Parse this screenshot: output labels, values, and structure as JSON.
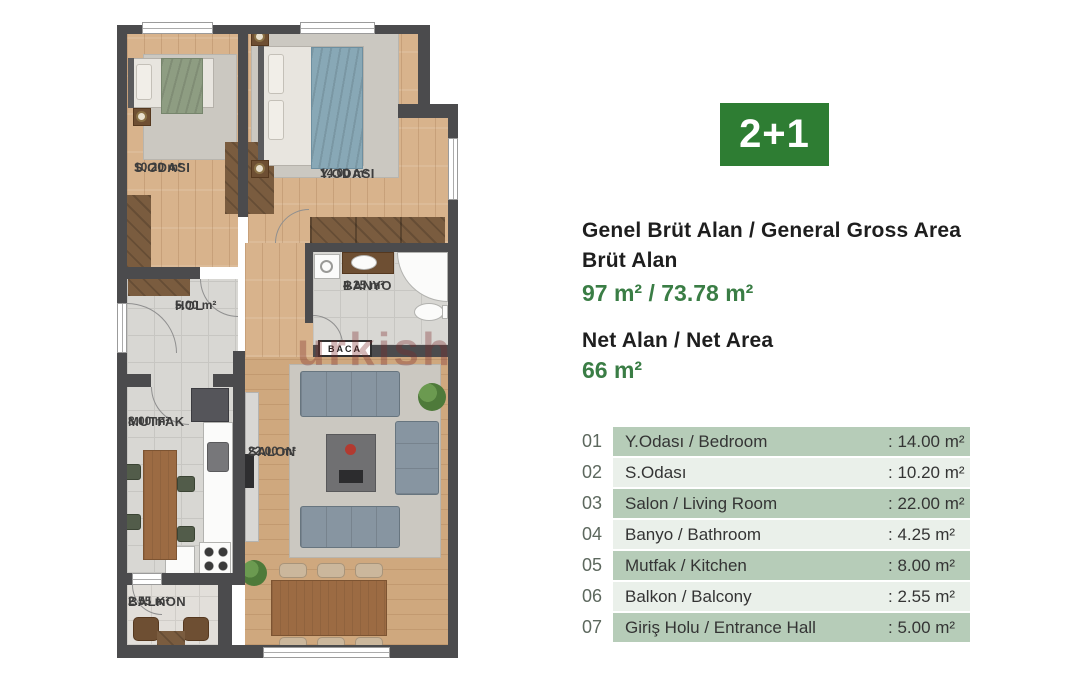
{
  "badge": {
    "label": "2+1"
  },
  "colors": {
    "badge_green": "#2e7d33",
    "value_green": "#3a7d45",
    "row_dark": "#b6ccb8",
    "row_light": "#eaf0ea",
    "number_gray": "#5d685e",
    "text_dark": "#1e1e1e",
    "wall": "#4b4b4d"
  },
  "summary": {
    "gross_title": "Genel Brüt Alan / General Gross Area",
    "gross_subtitle": "Brüt Alan",
    "gross_value": "97 m² / 73.78 m²",
    "net_title": "Net Alan / Net Area",
    "net_value": "66 m²"
  },
  "rooms_table": [
    {
      "num": "01",
      "name": "Y.Odası / Bedroom",
      "value": ": 14.00 m²"
    },
    {
      "num": "02",
      "name": "S.Odası",
      "value": ": 10.20 m²"
    },
    {
      "num": "03",
      "name": "Salon / Living Room",
      "value": ": 22.00 m²"
    },
    {
      "num": "04",
      "name": "Banyo / Bathroom",
      "value": ": 4.25 m²"
    },
    {
      "num": "05",
      "name": "Mutfak / Kitchen",
      "value": ": 8.00 m²"
    },
    {
      "num": "06",
      "name": "Balkon / Balcony",
      "value": ": 2.55 m²"
    },
    {
      "num": "07",
      "name": "Giriş Holu / Entrance Hall",
      "value": ": 5.00 m²"
    }
  ],
  "plan": {
    "labels": {
      "sodasi": {
        "name": "S.ODASI",
        "area": "10.20 m²"
      },
      "yodasi": {
        "name": "Y.ODASI",
        "area": "14.00 m²"
      },
      "banyo": {
        "name": "BANYO",
        "area": "4.25 m²"
      },
      "hol": {
        "name": "HOL",
        "area": "5.00 m²"
      },
      "mutfak": {
        "name": "MUTFAK",
        "area": "8.00 m²"
      },
      "salon": {
        "name": "SALON",
        "area": "22.00 m²"
      },
      "balkon": {
        "name": "BALKON",
        "area": "2.55 m²"
      }
    },
    "baca": "BACA",
    "watermark": "urkish"
  }
}
